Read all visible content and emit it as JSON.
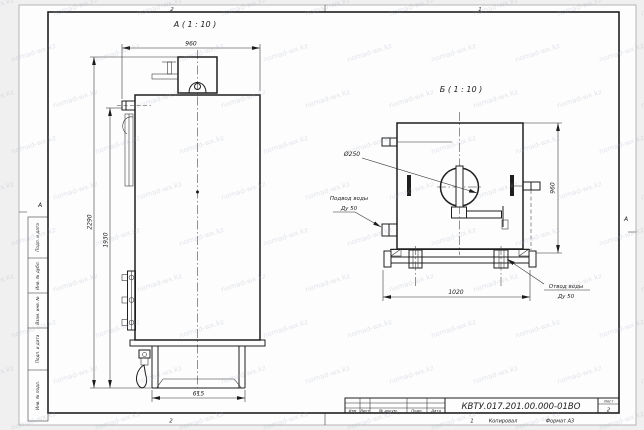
{
  "watermark": {
    "text": "nomad-wx.kz"
  },
  "frame": {
    "zones": {
      "top_left": "2",
      "top_right": "1",
      "bottom_left": "2",
      "bottom_right": "1",
      "left": "А",
      "right": "А"
    },
    "left_fields": [
      "Подп. и дата",
      "Инв. № дубл.",
      "Взам. инв. №",
      "Подп. и дата",
      "Инв. № подл."
    ],
    "footer": {
      "copied_by": "Копировал",
      "format": "Формат А3"
    }
  },
  "title_block": {
    "doc_number": "КВТУ.017.201.00.000-01ВО",
    "sheet_label": "Лист",
    "sheet_number": "2",
    "columns": [
      "Изм",
      "Лист",
      "№ докум.",
      "Подп.",
      "Дата"
    ]
  },
  "views": {
    "a": {
      "label": "А ( 1 : 10 )",
      "dim_width": "960",
      "dim_height_total": "2290",
      "dim_height_outlet": "1930",
      "dim_base": "615"
    },
    "b": {
      "label": "Б ( 1 : 10 )",
      "dim_height": "960",
      "dim_width": "1020",
      "flue": "Ø250",
      "inlet": {
        "line1": "Подвод воды",
        "line2": "Ду 50"
      },
      "outlet": {
        "line1": "Отвод воды",
        "line2": "Ду 50"
      }
    }
  }
}
